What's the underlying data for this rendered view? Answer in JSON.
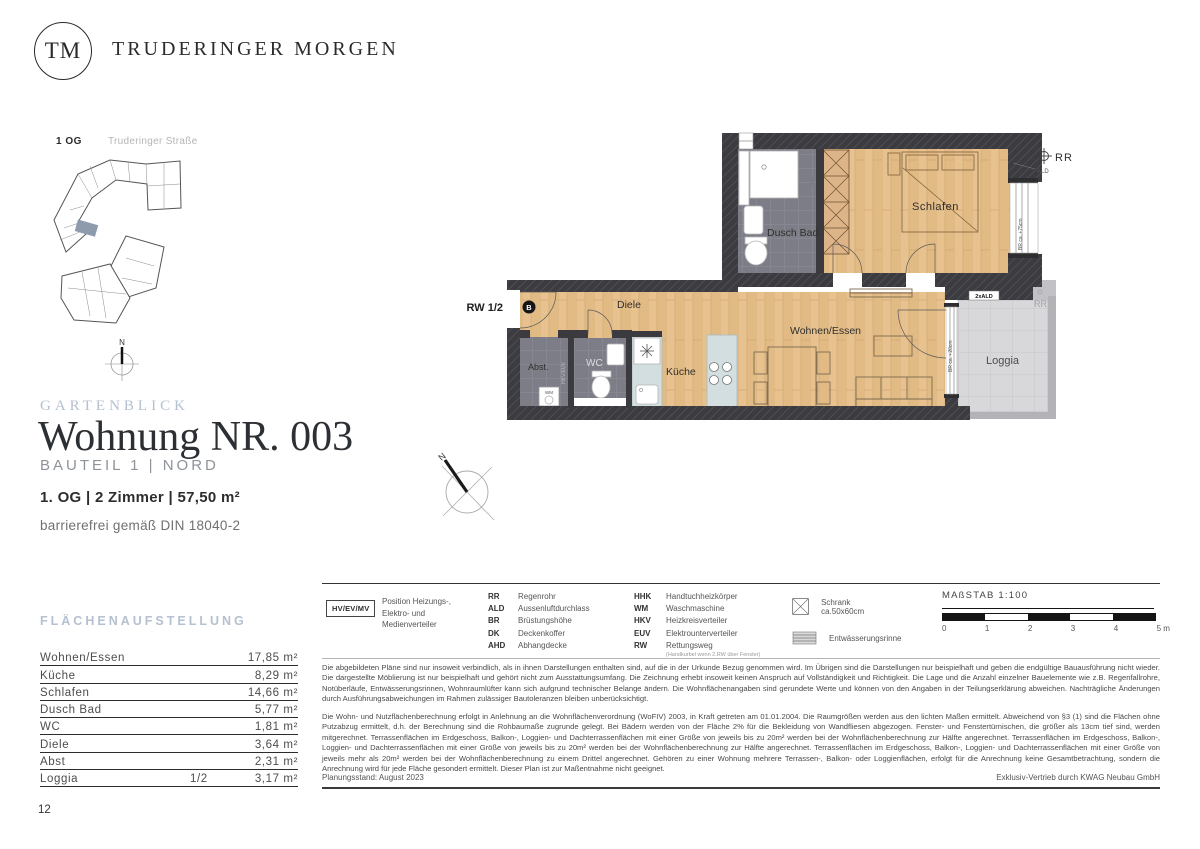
{
  "brand": {
    "logo_initials": "TM",
    "name": "TRUDERINGER MORGEN"
  },
  "site_plan": {
    "floor_label": "1 OG",
    "street_label": "Truderinger Straße",
    "compass": "N"
  },
  "floor_plan": {
    "rooms": {
      "schlafen": "Schlafen",
      "dusch_bad": "Dusch Bad",
      "diele": "Diele",
      "wohnen_essen": "Wohnen/Essen",
      "kueche": "Küche",
      "loggia": "Loggia",
      "abst": "Abst.",
      "wc": "WC"
    },
    "annotations": {
      "rescue_route": "RW 1/2",
      "entrance_marker": "B",
      "rr_top": "RR",
      "ald_top": "ALD",
      "ald_loggia": "2xALD",
      "rr_loggia": "RR",
      "parapet_window": "BR ca. +75cm",
      "parapet_loggia_door": "BR ca. +20cm",
      "hkv_euv": "HKV/EUV",
      "wm": "WM",
      "hhk": "HHK",
      "compass": "N"
    }
  },
  "title_block": {
    "project": "GARTENBLICK",
    "title": "Wohnung NR. 003",
    "subtitle": "BAUTEIL 1 | NORD",
    "details": "1. OG | 2 Zimmer | 57,50 m²",
    "accessibility": "barrierefrei gemäß DIN 18040-2"
  },
  "area_table": {
    "heading": "FLÄCHENAUFSTELLUNG",
    "rows": [
      {
        "label": "Wohnen/Essen",
        "fraction": "",
        "value": "17,85 m²"
      },
      {
        "label": "Küche",
        "fraction": "",
        "value": "8,29 m²"
      },
      {
        "label": "Schlafen",
        "fraction": "",
        "value": "14,66 m²"
      },
      {
        "label": "Dusch Bad",
        "fraction": "",
        "value": "5,77 m²"
      },
      {
        "label": "WC",
        "fraction": "",
        "value": "1,81 m²"
      },
      {
        "label": "Diele",
        "fraction": "",
        "value": "3,64 m²"
      },
      {
        "label": "Abst",
        "fraction": "",
        "value": "2,31 m²"
      },
      {
        "label": "Loggia",
        "fraction": "1/2",
        "value": "3,17 m²"
      }
    ]
  },
  "legend": {
    "hv_box_label": "HV/EV/MV",
    "hv_description": "Position Heizungs-, Elektro- und Medienverteiler",
    "col1": [
      {
        "abbr": "RR",
        "name": "Regenrohr"
      },
      {
        "abbr": "ALD",
        "name": "Aussenluftdurchlass"
      },
      {
        "abbr": "BR",
        "name": "Brüstungshöhe"
      },
      {
        "abbr": "DK",
        "name": "Deckenkoffer"
      },
      {
        "abbr": "AHD",
        "name": "Abhangdecke"
      }
    ],
    "col2": [
      {
        "abbr": "HHK",
        "name": "Handtuchheizkörper"
      },
      {
        "abbr": "WM",
        "name": "Waschmaschine"
      },
      {
        "abbr": "HKV",
        "name": "Heizkreisverteiler"
      },
      {
        "abbr": "EUV",
        "name": "Elektrounterverteiler"
      },
      {
        "abbr": "RW",
        "name": "Rettungsweg",
        "note": "(Handkurbel wenn 2.RW über Fenster)"
      }
    ],
    "symbols": [
      {
        "label": "Schrank ca.50x60cm"
      },
      {
        "label": "Entwässerungsrinne"
      }
    ],
    "scale": {
      "label": "MAßSTAB 1:100",
      "ticks": [
        "0",
        "1",
        "2",
        "3",
        "4",
        "5 m"
      ]
    }
  },
  "disclaimer": {
    "p1": "Die abgebildeten Pläne sind nur insoweit verbindlich, als in ihnen Darstellungen enthalten sind, auf die in der Urkunde Bezug genommen wird. Im Übrigen sind die Darstellungen nur beispielhaft und geben die endgültige Bauausführung nicht wieder. Die dargestellte Möblierung ist nur beispielhaft und gehört nicht zum Ausstattungsumfang. Die Zeichnung erhebt insoweit keinen Anspruch auf Vollständigkeit und Richtigkeit. Die Lage und die Anzahl einzelner Bauelemente wie z.B. Regenfallrohre, Notüberläufe, Entwässerungsrinnen, Wohnraumlüfter kann sich aufgrund technischer Belange ändern. Die Wohnflächenangaben sind gerundete Werte und können von den Angaben in der Teilungserklärung abweichen. Nachträgliche Änderungen durch Ausführungsabweichungen im Rahmen zulässiger Bautoleranzen bleiben unberücksichtigt.",
    "p2": "Die Wohn- und Nutzflächenberechnung erfolgt in Anlehnung an die Wohnflächenverordnung (WoFIV) 2003, in Kraft getreten am 01.01.2004. Die Raumgrößen werden aus den lichten Maßen ermittelt. Abweichend von §3 (1) sind die Flächen ohne Putzabzug ermittelt, d.h. der Berechnung sind die Rohbaumaße zugrunde gelegt. Bei Bädern werden von der Fläche 2% für die Bekleidung von Wandfliesen abgezogen. Fenster- und Fenstertürnischen, die größer als 13cm tief sind, werden mitgerechnet. Terrassenflächen im Erdgeschoss, Balkon-, Loggien- und Dachterrassenflächen mit einer Größe von jeweils bis zu 20m² werden bei der Wohnflächenberechnung zur Hälfte angerechnet. Terrassenflächen im Erdgeschoss, Balkon-, Loggien- und Dachterrassenflächen mit einer Größe von jeweils bis zu 20m² werden bei der Wohnflächenberechnung zur Hälfte angerechnet. Terrassenflächen im Erdgeschoss, Balkon-, Loggien- und Dachterrassenflächen mit einer Größe von jeweils mehr als 20m² werden bei der Wohnflächenberechnung zu einem Drittel angerechnet. Gehören zu einer Wohnung mehrere Terrassen-, Balkon- oder Loggienflächen, erfolgt für die Anrechnung keine Gesamtbetrachtung, sondern die Anrechnung wird für jede Fläche gesondert ermittelt. Dieser Plan ist zur Maßentnahme nicht geeignet.",
    "colors": {
      "accent": "#b5c1cf",
      "wall": "#3b3b40",
      "wood": "#e7c28f",
      "tile": "#7d7d87",
      "loggia": "#d8d8da",
      "counter": "#d2dee0",
      "unit_highlight": "#8e9bad"
    }
  },
  "footer": {
    "planning_status": "Planungsstand: August 2023",
    "distribution": "Exklusiv-Vertrieb durch KWAG Neubau GmbH",
    "page_number": "12"
  }
}
